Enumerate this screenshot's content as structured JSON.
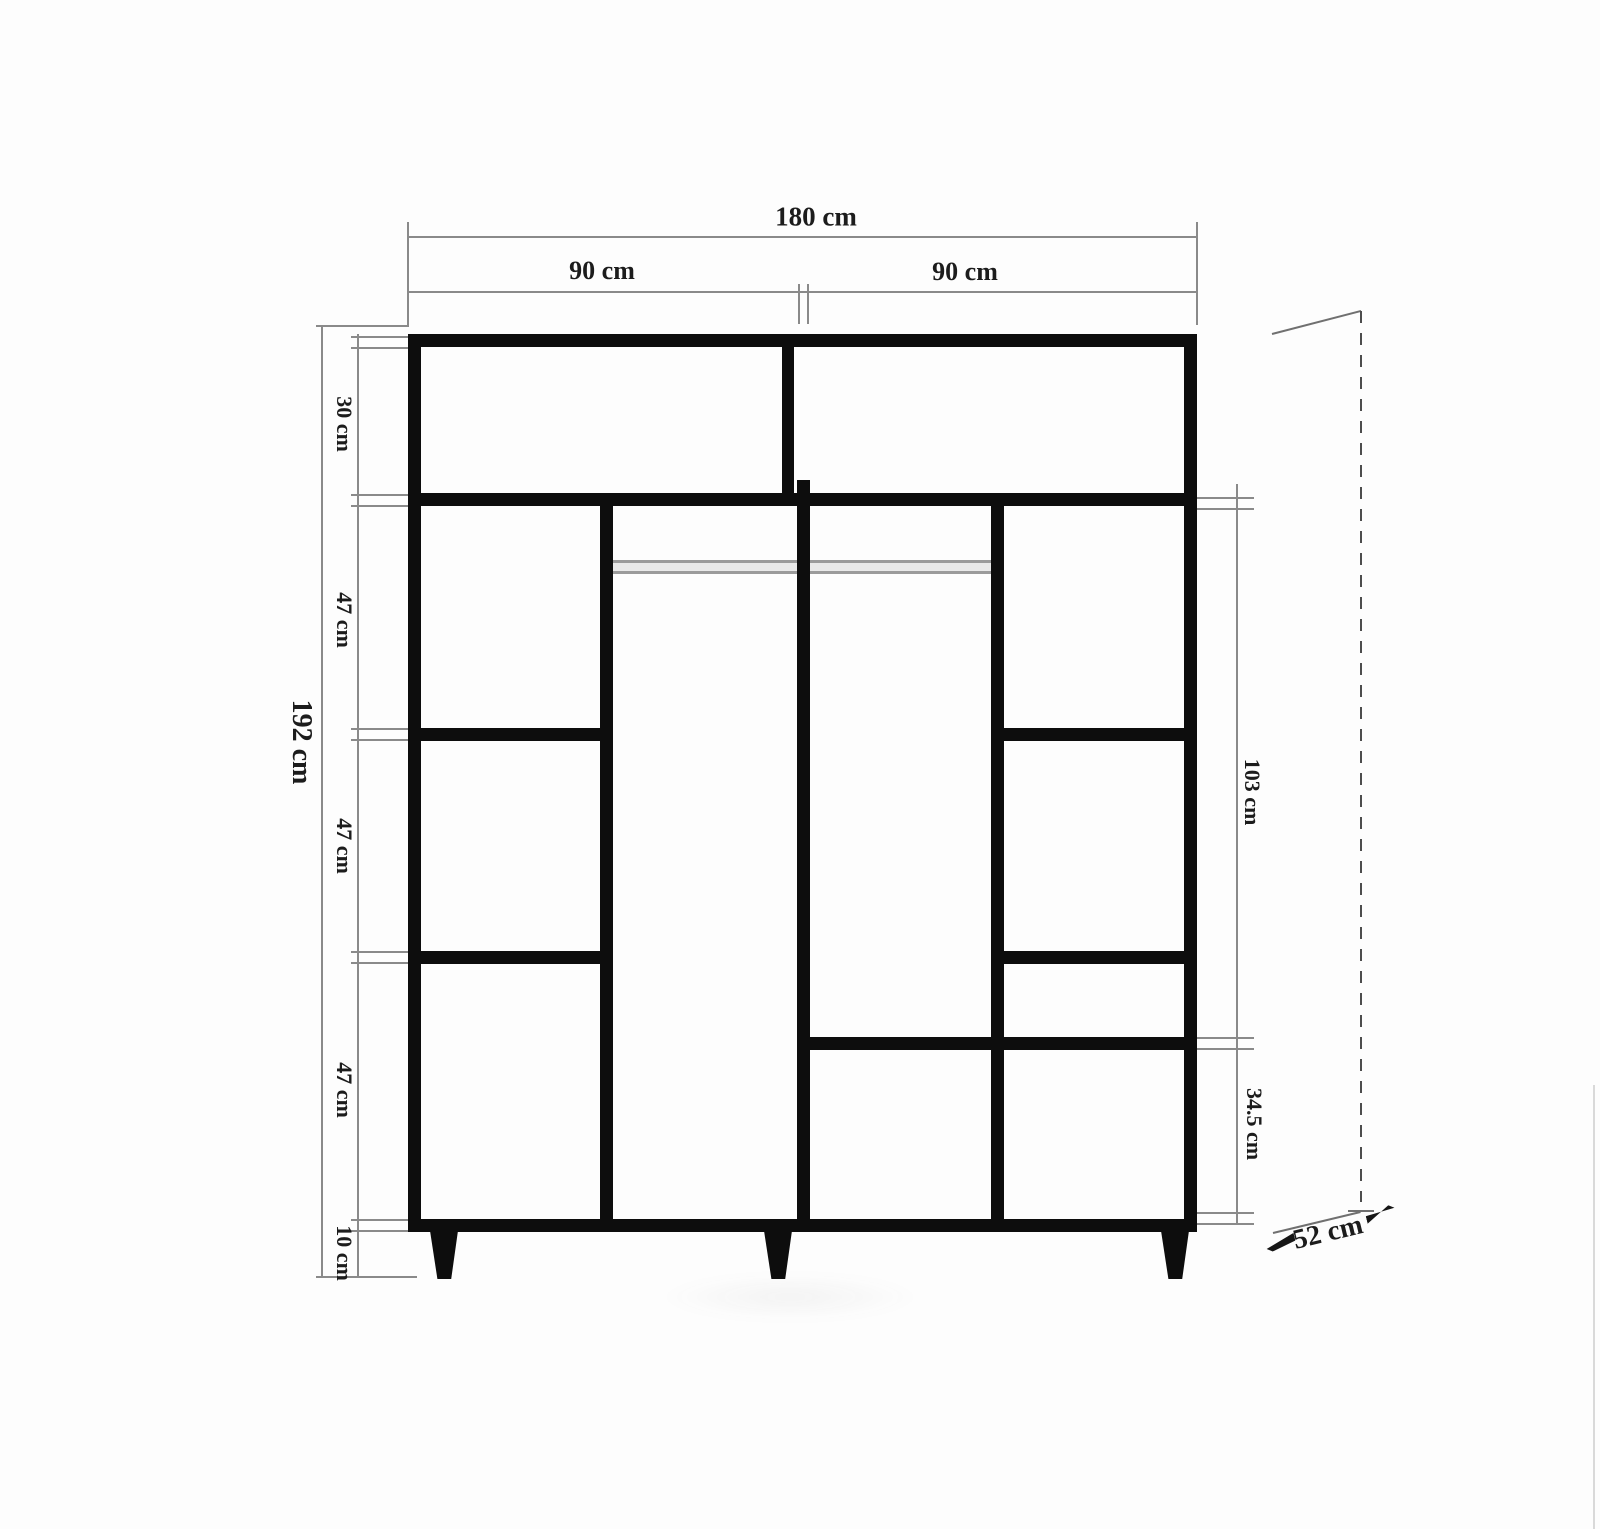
{
  "drawing": {
    "type": "wardrobe-front-elevation-technical-drawing",
    "width_total": "180 cm",
    "width_left_door": "90 cm",
    "width_right_door": "90 cm",
    "height_total": "192 cm",
    "height_segments": [
      "30 cm",
      "47 cm",
      "47 cm",
      "47 cm",
      "10 cm"
    ],
    "right_side_segments": [
      "103 cm",
      "34.5 cm"
    ],
    "depth": "52 cm",
    "colors": {
      "cabinet_line": "#0d0d0d",
      "dimension_line": "#8a8a8a",
      "label_text": "#1c1c1c",
      "rail": "#9b9b9b",
      "paper": "#fdfdfd"
    }
  }
}
